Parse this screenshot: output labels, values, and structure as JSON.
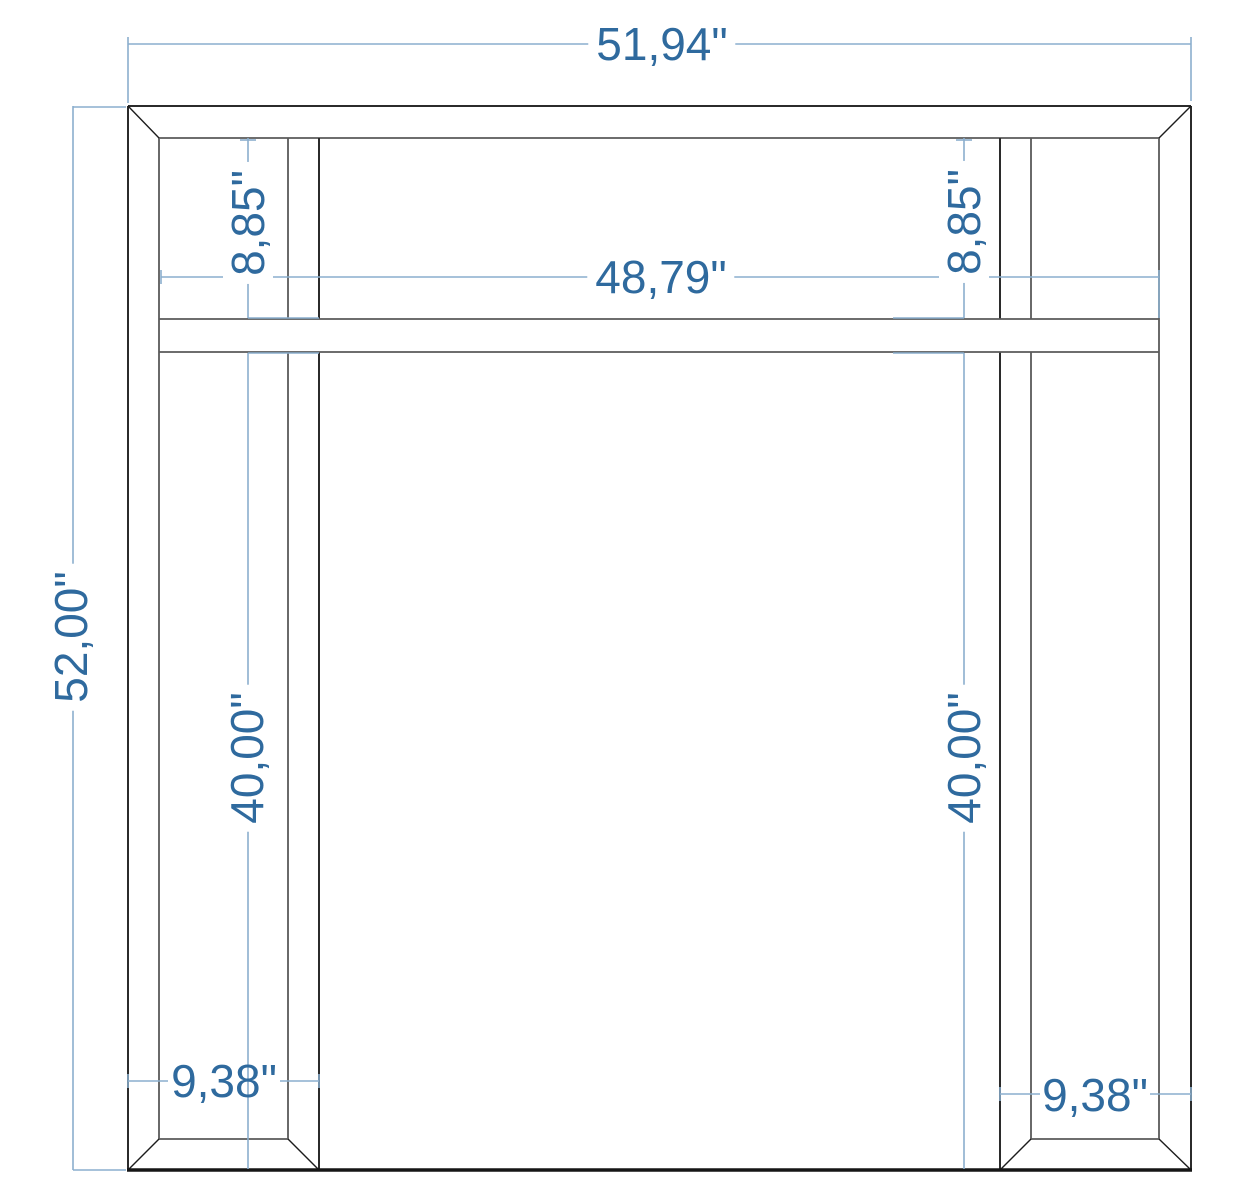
{
  "colors": {
    "dimension_text": "#2f6a9e",
    "dimension_line": "#8aaecd",
    "geometry_line": "#2b2b2b",
    "geometry_line_soft": "#5a5a5a",
    "floor_line": "#161616",
    "background": "#ffffff"
  },
  "drawing": {
    "type": "frame-elevation-technical-drawing",
    "unit": "in"
  },
  "dimensions": {
    "overall_width": {
      "label": "51,94\"",
      "value": 51.94,
      "orientation": "horizontal"
    },
    "overall_height": {
      "label": "52,00\"",
      "value": 52.0,
      "orientation": "vertical"
    },
    "inner_width": {
      "label": "48,79\"",
      "value": 48.79,
      "orientation": "horizontal"
    },
    "frieze_height_left": {
      "label": "8,85\"",
      "value": 8.85,
      "orientation": "vertical"
    },
    "frieze_height_right": {
      "label": "8,85\"",
      "value": 8.85,
      "orientation": "vertical"
    },
    "leg_height_left": {
      "label": "40,00\"",
      "value": 40.0,
      "orientation": "vertical"
    },
    "leg_height_right": {
      "label": "40,00\"",
      "value": 40.0,
      "orientation": "vertical"
    },
    "leg_width_left": {
      "label": "9,38\"",
      "value": 9.38,
      "orientation": "horizontal"
    },
    "leg_width_right": {
      "label": "9,38\"",
      "value": 9.38,
      "orientation": "horizontal"
    }
  }
}
